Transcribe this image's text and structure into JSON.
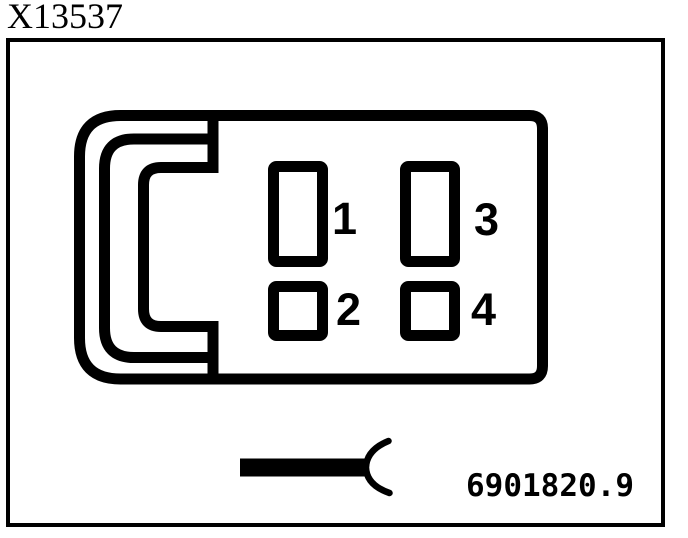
{
  "title": "X13537",
  "diagram": {
    "pins": [
      {
        "label": "1"
      },
      {
        "label": "2"
      },
      {
        "label": "3"
      },
      {
        "label": "4"
      }
    ],
    "part_number": "6901820.9",
    "colors": {
      "line": "#000000",
      "background": "#ffffff"
    }
  }
}
